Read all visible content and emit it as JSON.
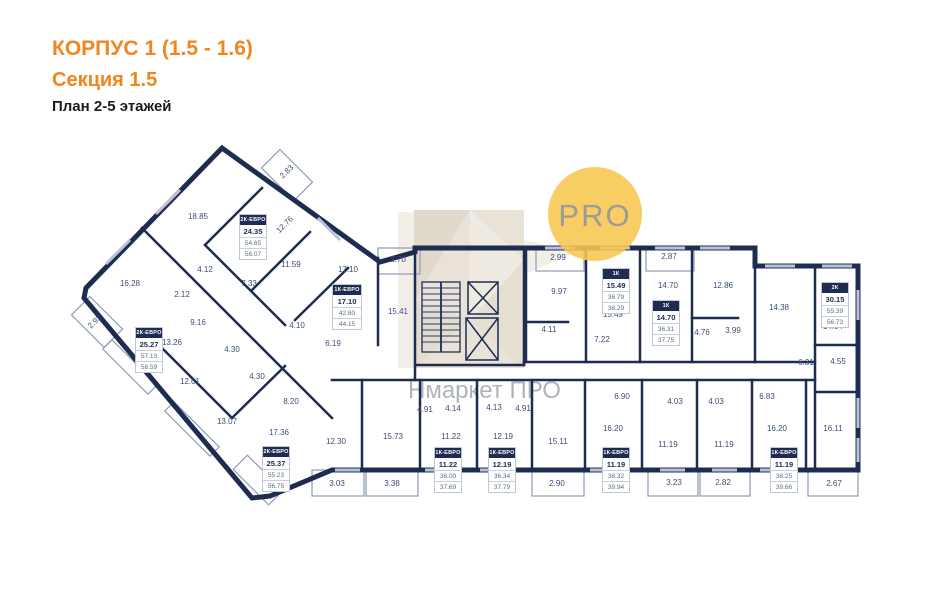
{
  "header": {
    "building": "КОРПУС 1 (1.5 - 1.6)",
    "section": "Секция 1.5",
    "plan": "План 2-5 этажей"
  },
  "branding": {
    "logo_text": "PRO",
    "watermark": "Нмаркет ПРО"
  },
  "colors": {
    "accent_orange": "#f0861d",
    "wall_navy": "#1e2c52",
    "logo_gold": "#f6c64e",
    "watermark_beige": "#d9d0bd",
    "dim_text": "#3d4d79"
  },
  "apartments": [
    {
      "type": "2К-ЕВРО",
      "area": "24.35",
      "a1": "54.65",
      "a2": "56.07"
    },
    {
      "type": "1К-ЕВРО",
      "area": "17.10",
      "a1": "42.80",
      "a2": "44.15"
    },
    {
      "type": "2К-ЕВРО",
      "area": "25.27",
      "a1": "57.13",
      "a2": "58.59"
    },
    {
      "type": "2К-ЕВРО",
      "area": "25.37",
      "a1": "55.23",
      "a2": "56.75"
    },
    {
      "type": "1К",
      "area": "15.49",
      "a1": "36.79",
      "a2": "38.29"
    },
    {
      "type": "1К",
      "area": "14.70",
      "a1": "36.31",
      "a2": "37.75"
    },
    {
      "type": "2К",
      "area": "30.15",
      "a1": "55.39",
      "a2": "56.73"
    },
    {
      "type": "1К-ЕВРО",
      "area": "11.22",
      "a1": "36.00",
      "a2": "37.69"
    },
    {
      "type": "1К-ЕВРО",
      "area": "12.19",
      "a1": "36.34",
      "a2": "37.79"
    },
    {
      "type": "1К-ЕВРО",
      "area": "11.19",
      "a1": "38.32",
      "a2": "39.94"
    },
    {
      "type": "1К-ЕВРО",
      "area": "11.19",
      "a1": "38.25",
      "a2": "39.66"
    }
  ],
  "dimensions": [
    "2.83",
    "18.85",
    "12.76",
    "16.28",
    "11.59",
    "4.12",
    "2.12",
    "7.33",
    "2.92",
    "9.16",
    "13.26",
    "4.30",
    "4.30",
    "12.01",
    "13.07",
    "8.20",
    "17.36",
    "4.10",
    "6.19",
    "17.10",
    "2.70",
    "15.41",
    "2.99",
    "9.97",
    "4.11",
    "7.22",
    "15.49",
    "2.87",
    "14.70",
    "12.86",
    "4.76",
    "3.99",
    "14.38",
    "14.04",
    "6.31",
    "4.55",
    "6.83",
    "6.90",
    "4.03",
    "4.03",
    "16.20",
    "11.19",
    "11.19",
    "16.20",
    "16.11",
    "3.23",
    "2.82",
    "2.67",
    "4.91",
    "4.14",
    "4.13",
    "4.91",
    "11.22",
    "12.19",
    "15.11",
    "15.73",
    "12.30",
    "3.03",
    "3.38",
    "2.90"
  ]
}
